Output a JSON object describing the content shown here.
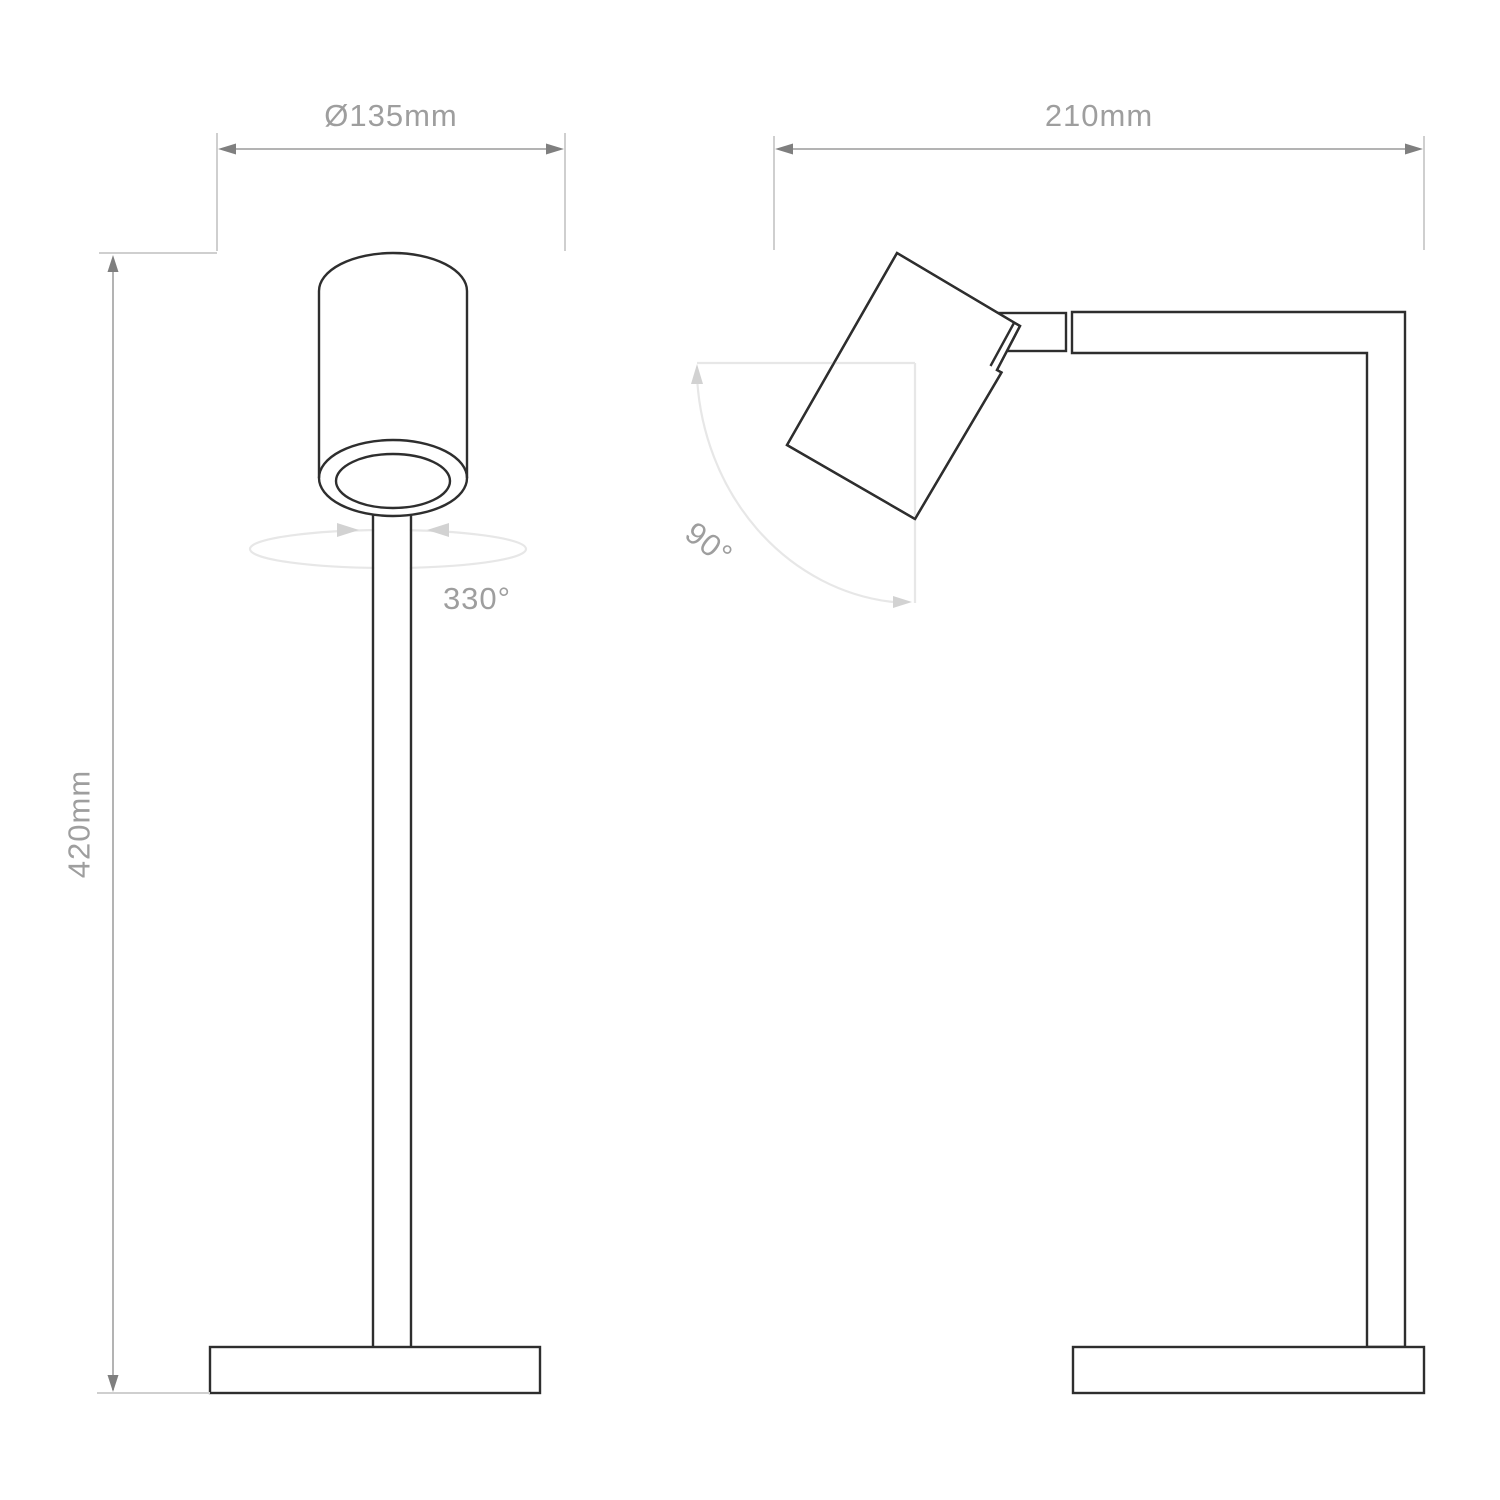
{
  "labels": {
    "front_diameter": "Ø135mm",
    "front_height": "420mm",
    "front_rotation": "330°",
    "side_width": "210mm",
    "side_tilt": "90°"
  },
  "dimensions": {
    "diameter_mm": 135,
    "height_mm": 420,
    "width_mm": 210,
    "head_rotation_deg": 330,
    "head_tilt_deg": 90
  },
  "colors": {
    "outline": "#2e2e2e",
    "dim-line": "#b3b3b3",
    "dim-arrow": "#7f7f7f",
    "ext-line": "#cfcfcf",
    "indicator": "#e7e7e7",
    "indicator-arrow": "#d2d2d2",
    "label": "#9e9e9e",
    "bg": "#ffffff"
  }
}
